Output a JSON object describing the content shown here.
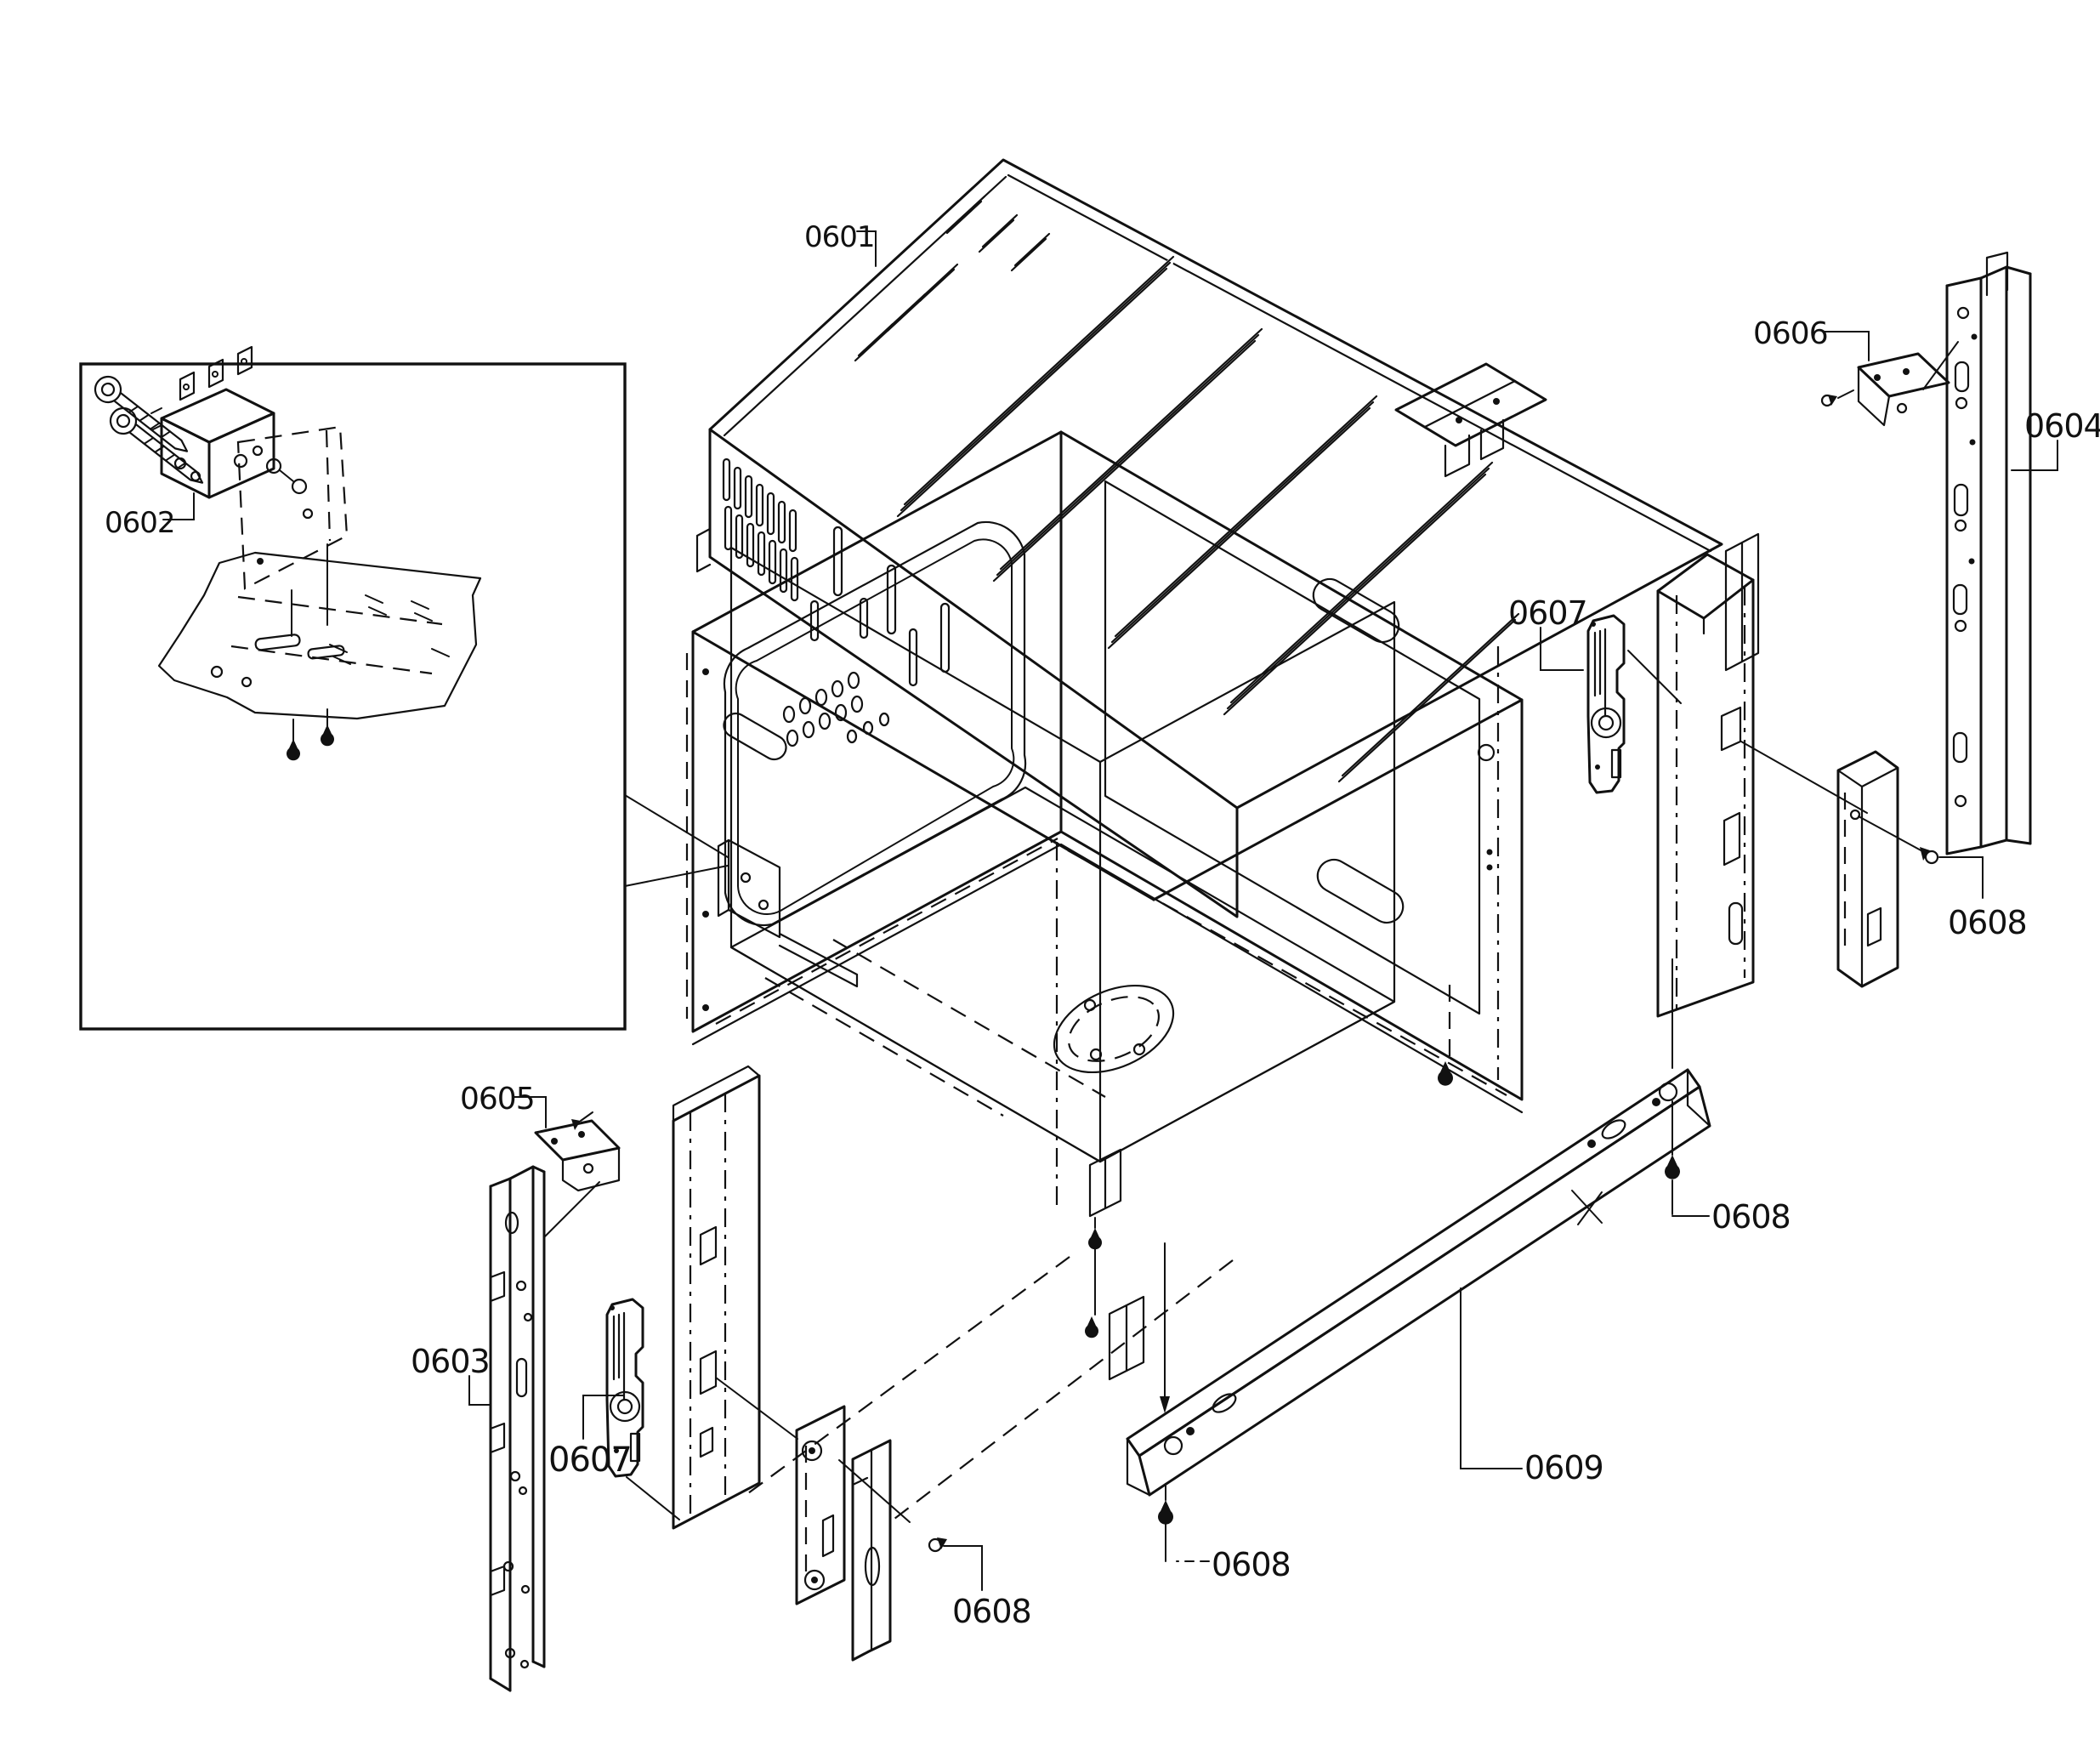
{
  "diagram": {
    "kind": "exploded-parts-line-drawing",
    "colors": {
      "background": "#ffffff",
      "line": "#111111"
    },
    "callouts": {
      "c0601": {
        "text": "0601"
      },
      "c0602": {
        "text": "0602"
      },
      "c0603": {
        "text": "0603"
      },
      "c0604": {
        "text": "0604"
      },
      "c0605": {
        "text": "0605"
      },
      "c0606": {
        "text": "0606"
      },
      "c0607_right": {
        "text": "0607"
      },
      "c0607_left": {
        "text": "0607"
      },
      "c0608_right": {
        "text": "0608"
      },
      "c0608_mid_right": {
        "text": "0608"
      },
      "c0608_bottom_left": {
        "text": "0608"
      },
      "c0608_bottom_center": {
        "text": "0608"
      },
      "c0609": {
        "text": "0609"
      }
    }
  }
}
